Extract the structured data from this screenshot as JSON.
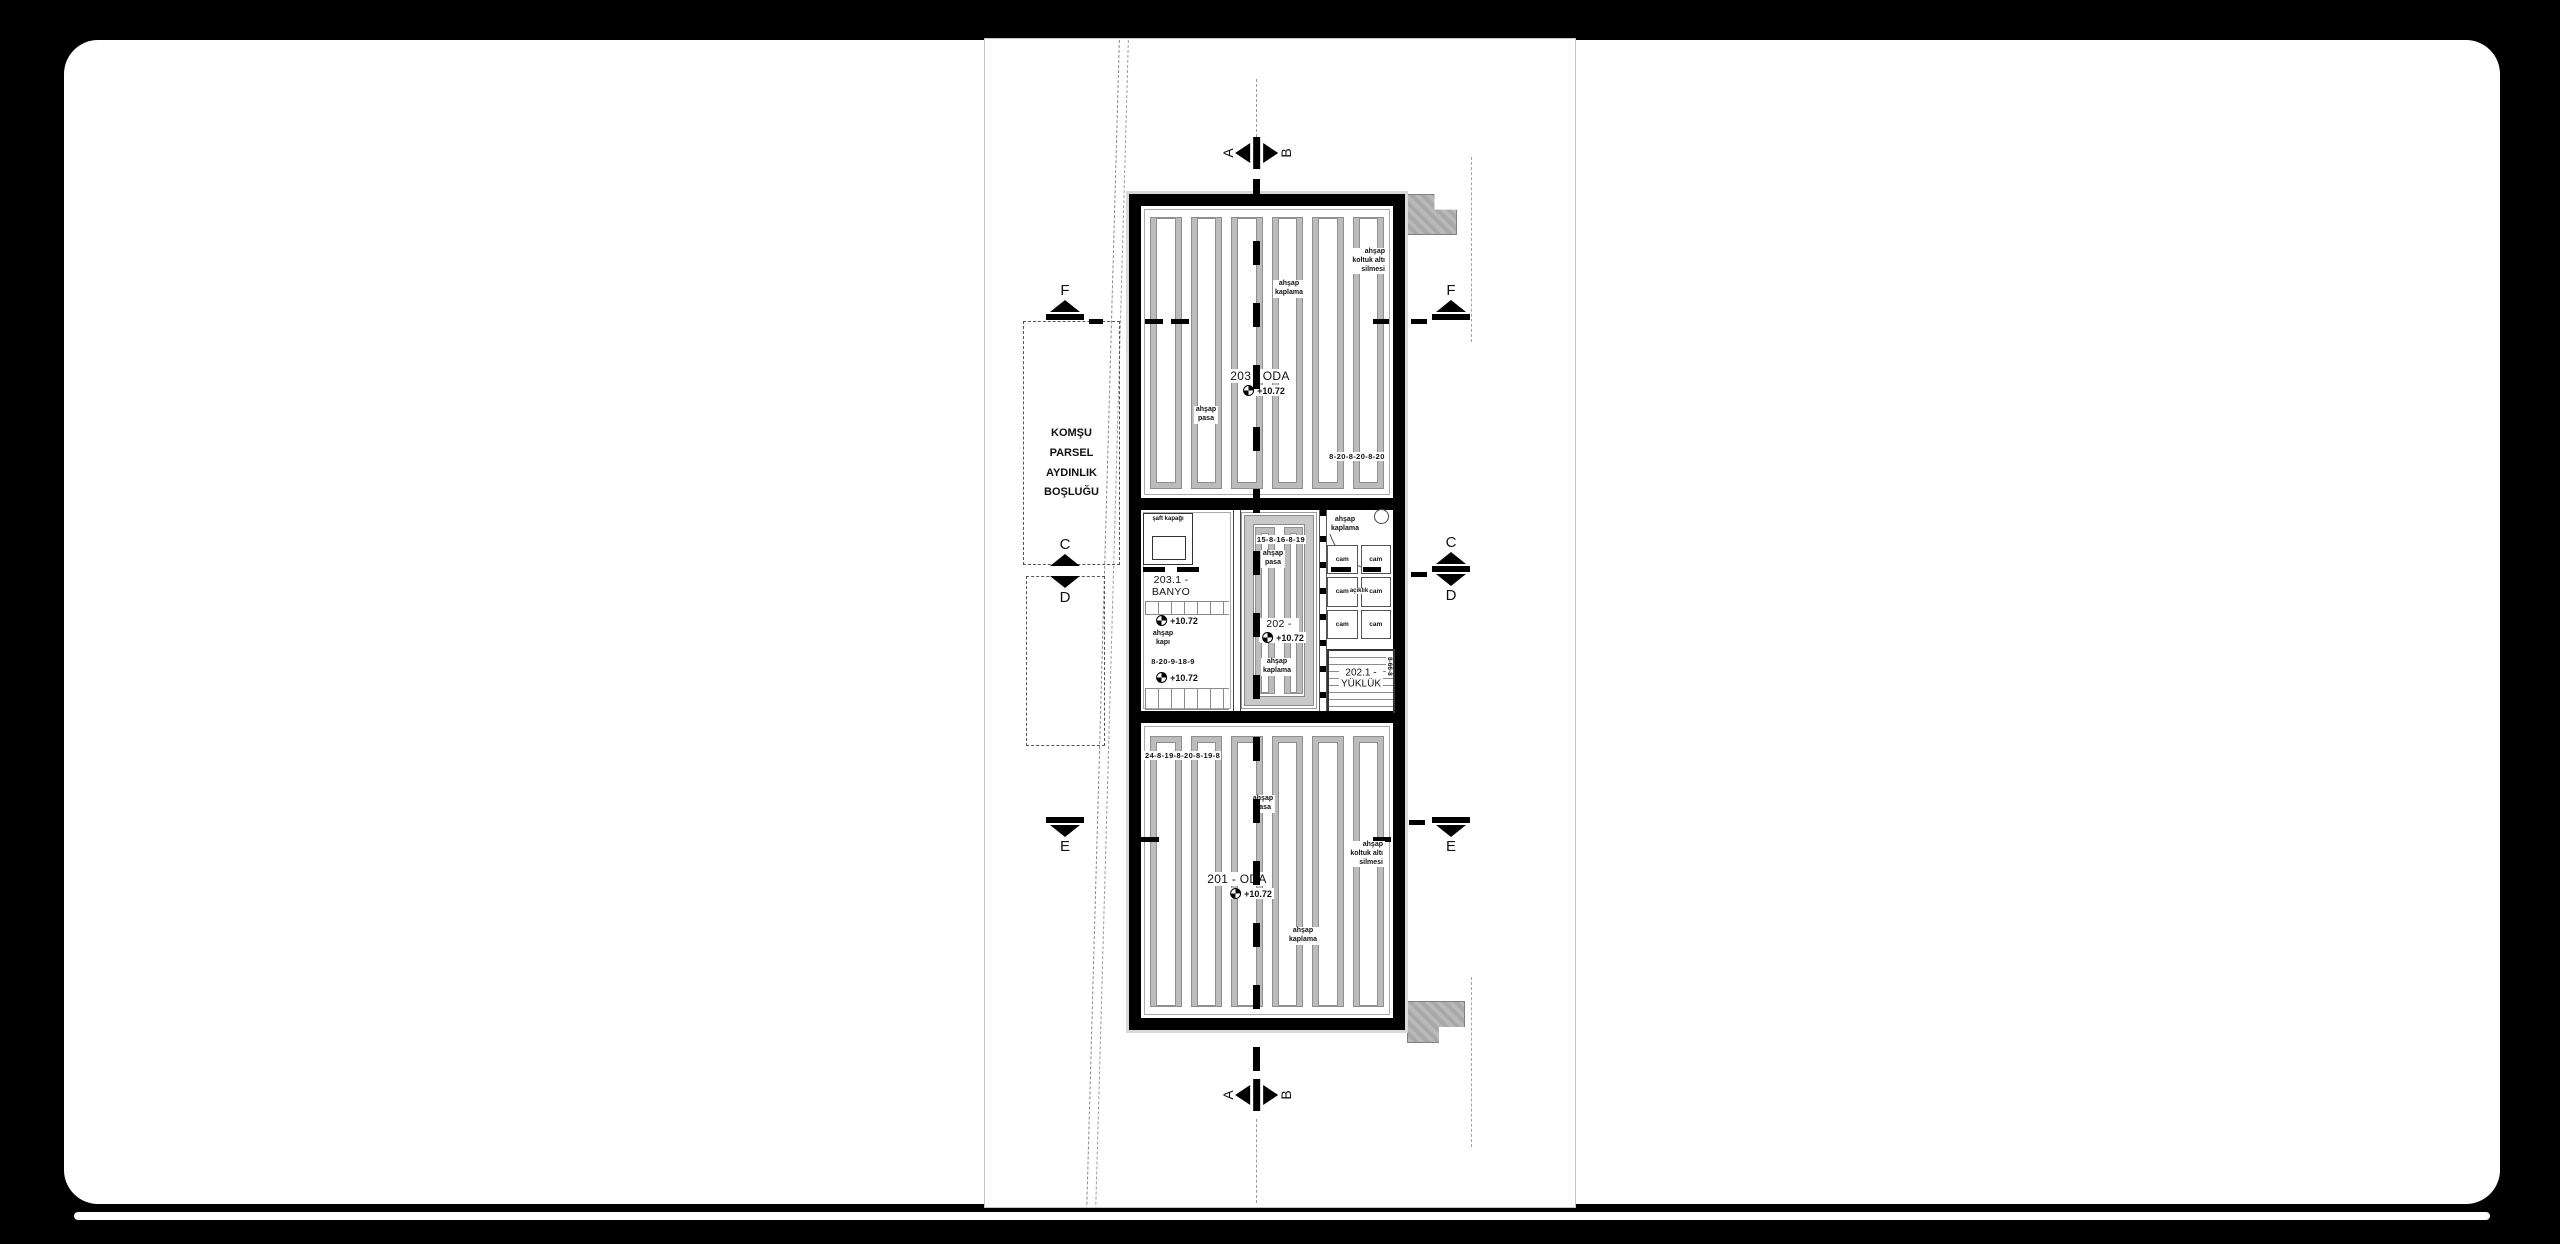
{
  "parcel_note": {
    "line1": "KOMŞU PARSEL",
    "line2": "AYDINLIK BOŞLUĞU"
  },
  "markers": {
    "a": "A",
    "b": "B",
    "c": "C",
    "d": "D",
    "e": "E",
    "f": "F"
  },
  "rooms": {
    "oda203": {
      "name": "203 - ODA",
      "elev": "+10.72",
      "pasa": "ahşap\npasa",
      "kaplama": "ahşap\nkaplama",
      "koltuk": "ahşap\nkoltuk altı\nsilmesi",
      "dim": "8-20-8-20-8-20"
    },
    "banyo": {
      "shaft": "şaft kapağı",
      "name": "203.1 -\nBANYO",
      "elev": "+10.72",
      "kapi": "ahşap\nkapı",
      "dim": "8-20-9-18-9",
      "elev2": "+10.72"
    },
    "sofa": {
      "dim": "15-8-16-8-19",
      "pasa": "ahşap\npasa",
      "name": "202 - SOFA",
      "elev": "+10.72",
      "kaplama": "ahşap\nkaplama"
    },
    "entry": {
      "kaplama": "ahşap\nkaplama",
      "cam": "cam",
      "aciklik": "açıklık"
    },
    "yukluk": {
      "name": "202.1 -\nYÜKLÜK",
      "vdim": "8-66-8"
    },
    "oda201": {
      "dim": "24-8-19-8-20-8-19-8",
      "pasa": "ahşap\npasa",
      "koltuk": "ahşap\nkoltuk altı\nsilmesi",
      "name": "201 - ODA",
      "elev": "+10.72",
      "kaplama": "ahşap\nkaplama"
    }
  }
}
